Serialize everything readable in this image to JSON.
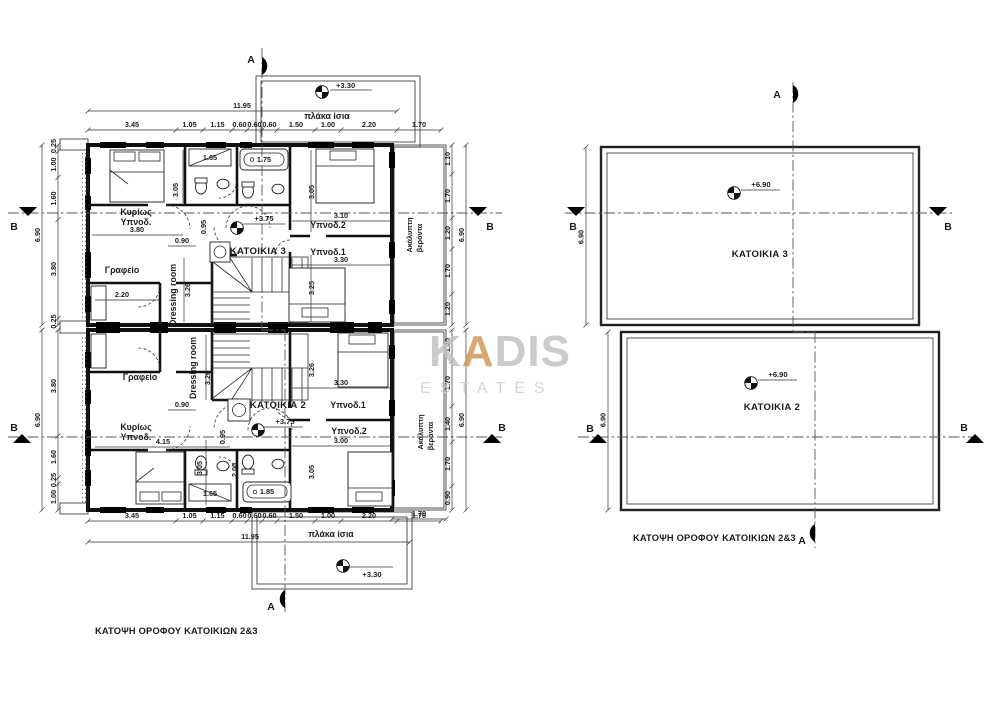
{
  "drawing": {
    "captions": {
      "left": "ΚΑΤΟΨΗ ΟΡΟΦΟΥ ΚΑΤΟΙΚΙΩΝ 2&3",
      "right": "ΚΑΤΟΨΗ ΟΡΟΦΟΥ ΚΑΤΟΙΚΙΩΝ 2&3"
    },
    "section_markers": {
      "a": "A",
      "b": "B"
    },
    "levels": {
      "slab": "+3.30",
      "floor": "+3.75",
      "roof": "+6.90"
    },
    "labels": {
      "flat_slab": "πλάκα ίσια",
      "veranda_line1": "Ακάλυπτη",
      "veranda_line2": "βεράντα",
      "unit3": "ΚΑΤΟΙΚΙΑ 3",
      "unit2": "ΚΑΤΟΙΚΙΑ 2",
      "master_line1": "Κυρίως",
      "master_line2": "Υπνοδ.",
      "office": "Γραφείο",
      "dressing": "Dressing room",
      "bedroom1": "Υπνοδ.1",
      "bedroom2": "Υπνοδ.2"
    },
    "dims": {
      "overall_width": "11.95",
      "overall_height": "6.90",
      "top_row": [
        "3.45",
        "1.05",
        "1.15",
        "0.60",
        "0.60",
        "0.60",
        "1.50",
        "1.00",
        "2.20",
        "1.70"
      ],
      "left_col_top": [
        "0.25",
        "1.00",
        "1.60",
        "3.80",
        "0.25"
      ],
      "left_col_bottom": [
        "3.80",
        "1.60",
        "0.25",
        "1.00"
      ],
      "right_col_top": [
        "1.10",
        "1.70",
        "1.20",
        "1.70",
        "1.20"
      ],
      "right_col_bottom": [
        "1.20",
        "1.70",
        "1.40",
        "1.70",
        "0.90"
      ],
      "veranda_width": "1.70",
      "unit3": {
        "master_bed": "3.80",
        "office": "2.20",
        "dressing_len": "3.26",
        "corridor": "0.90",
        "bath_len": "3.05",
        "entry": "0.95",
        "shower": "1.65",
        "bathtub": "1.75",
        "bed2_w": "3.10",
        "bed2_h": "3.05",
        "bed1_w": "3.30",
        "bed1_h": "3.25"
      },
      "unit2": {
        "master_bed": "4.15",
        "dressing_len": "3.26",
        "corridor": "0.90",
        "bath_len": "3.05",
        "shower_len": "2.00",
        "entry": "0.95",
        "shower": "1.65",
        "bathtub": "1.85",
        "bed1_w": "3.30",
        "bed1_h": "3.26",
        "bed2_w": "3.00",
        "bed2_h": "3.05"
      }
    },
    "roof_plan": {
      "unit3": "ΚΑΤΟΙΚΙΑ 3",
      "unit2": "ΚΑΤΟΙΚΙΑ 2",
      "height": "6.90",
      "level": "+6.90"
    }
  },
  "watermark": {
    "part1": "K",
    "accent": "A",
    "part2": "DIS",
    "subtitle": "ESTATES",
    "gray": "#c2c2c2",
    "accent_color": "#cf995a"
  }
}
